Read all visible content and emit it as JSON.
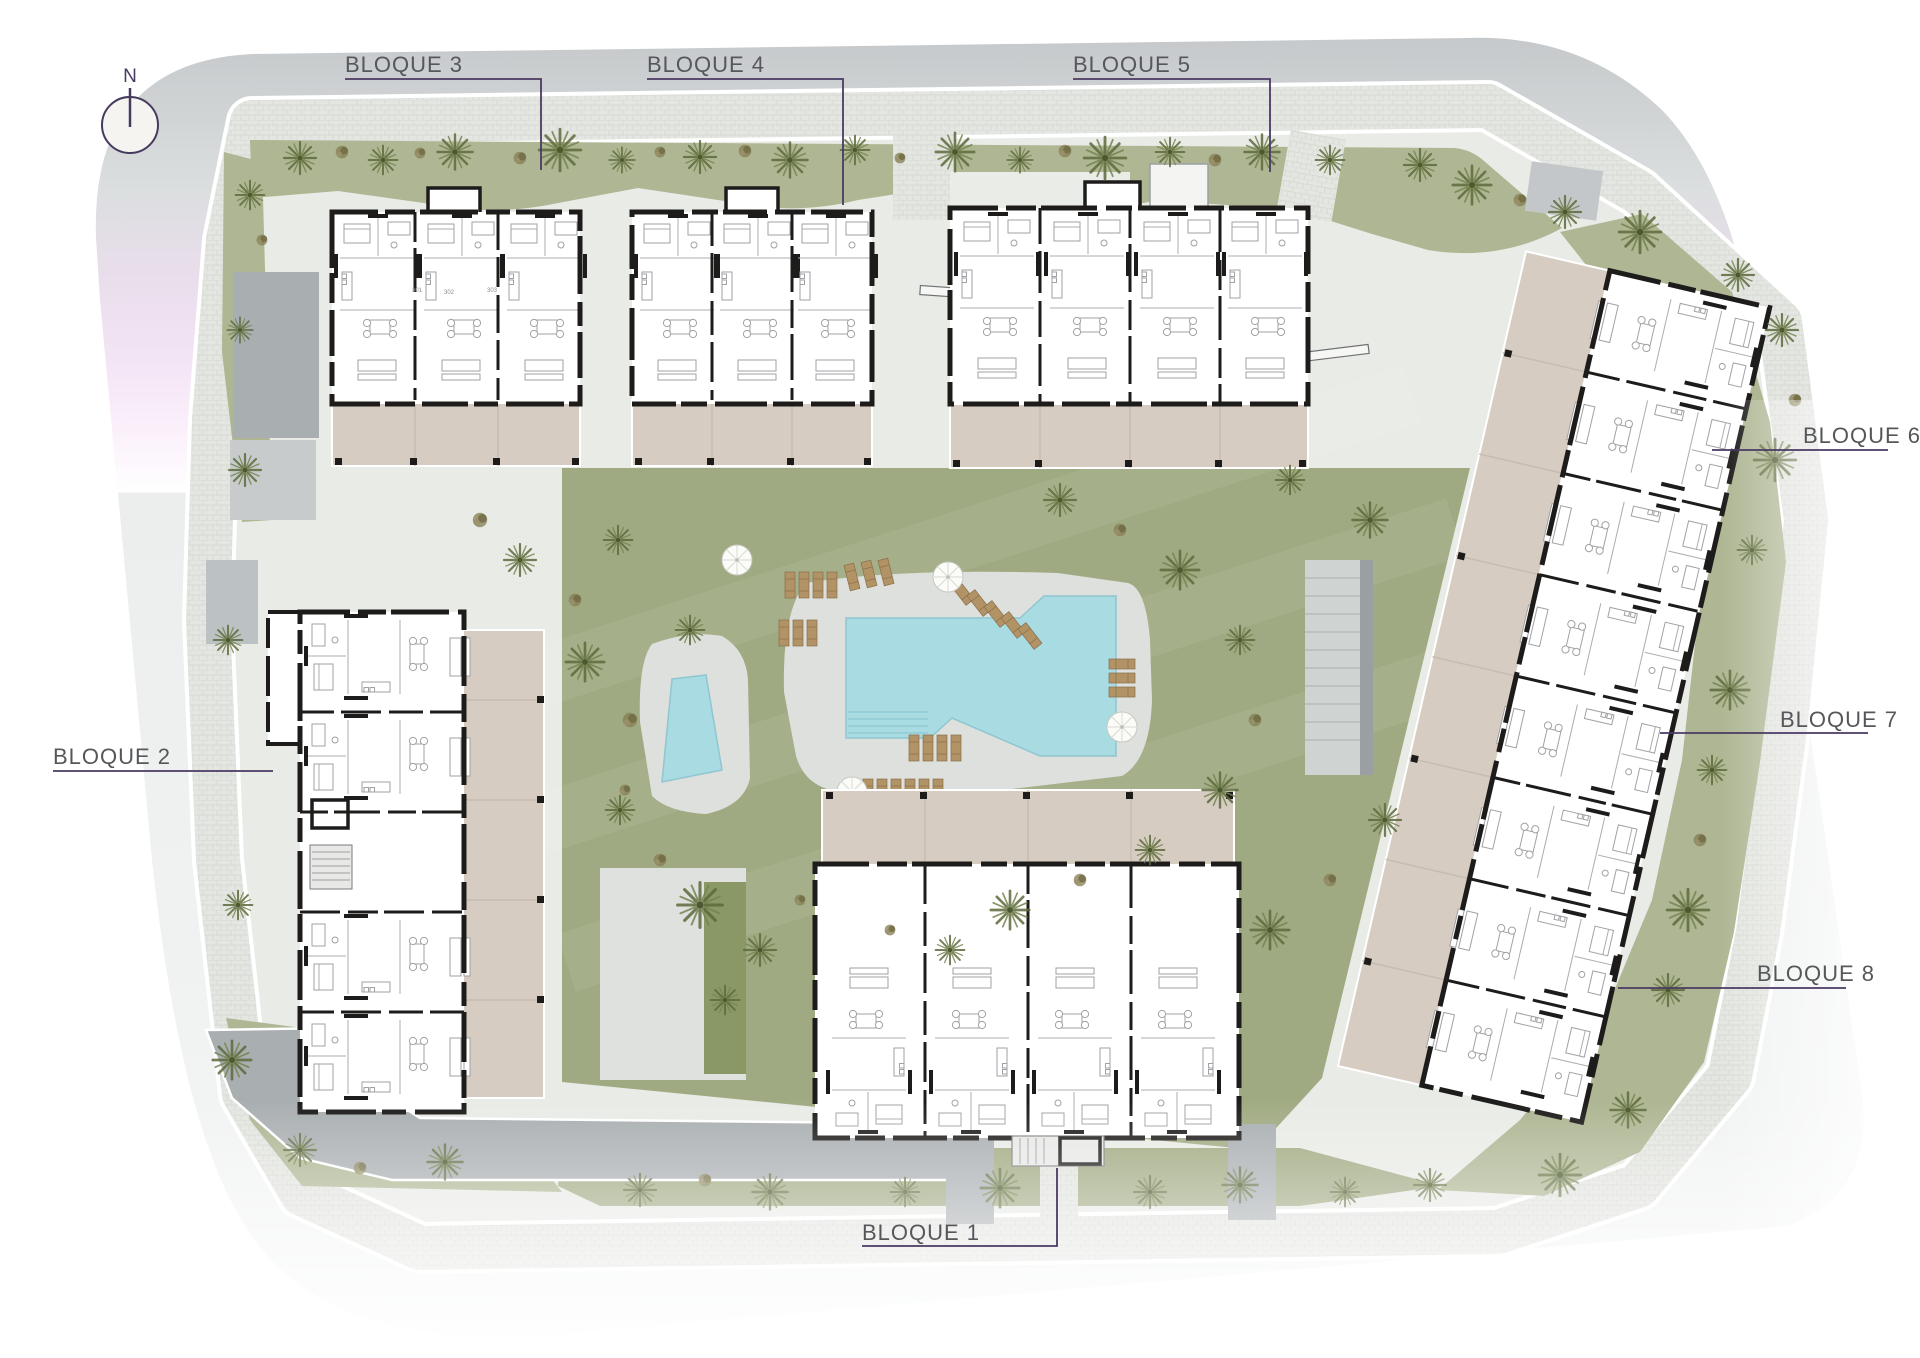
{
  "plan": {
    "type": "residential complex site plan",
    "compass": {
      "label": "N"
    },
    "block_labels": [
      {
        "id": 1,
        "text": "BLOQUE 1"
      },
      {
        "id": 2,
        "text": "BLOQUE 2"
      },
      {
        "id": 3,
        "text": "BLOQUE 3"
      },
      {
        "id": 4,
        "text": "BLOQUE 4"
      },
      {
        "id": 5,
        "text": "BLOQUE 5"
      },
      {
        "id": 6,
        "text": "BLOQUE 6"
      },
      {
        "id": 7,
        "text": "BLOQUE 7"
      },
      {
        "id": 8,
        "text": "BLOQUE 8"
      }
    ],
    "unit_numbers_visible": [
      "301",
      "302",
      "303"
    ],
    "features": [
      "main-pool",
      "kids-pool",
      "sun-loungers",
      "parasols",
      "lawn",
      "palm-trees",
      "paved-promenade"
    ],
    "colors": {
      "label_text": "#55575a",
      "leader": "#4a3a63",
      "street_dark": "#c6c9cb",
      "street_light": "#f1f2f2",
      "paver": "#e4e6e1",
      "grass": "#aeb693",
      "lawn": "#a0aa82",
      "water": "#a9dbe3",
      "deck": "#dde0dc",
      "terrace": "#d6ccc1",
      "building": "#ffffff",
      "wall": "#1d1c1b",
      "driveway": "#a9aeb1",
      "tree": "#6e7b4a",
      "lounger": "#b29366"
    }
  }
}
